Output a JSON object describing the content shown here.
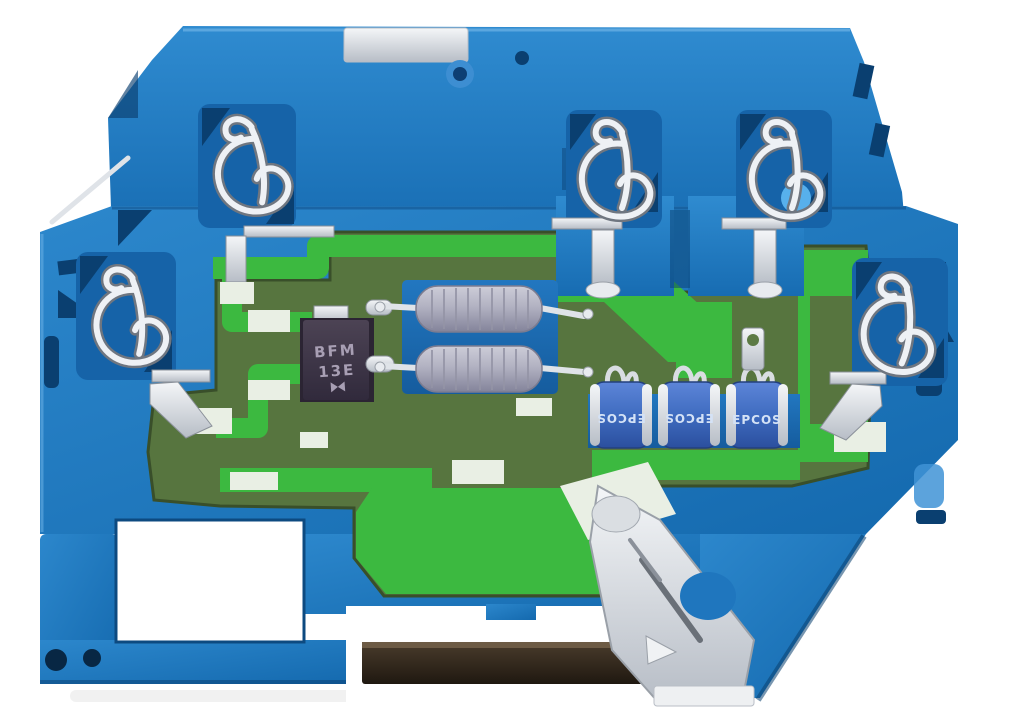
{
  "scene": {
    "subject": "Blue DIN-rail terminal block surge-protection module with exposed green PCB",
    "background": "#ffffff"
  },
  "labels": {
    "diode": {
      "line1": "BFM",
      "line2": "13E"
    },
    "gas_discharge_tubes": [
      {
        "brand": "EPCOS",
        "orientation": "upside-down"
      },
      {
        "brand": "EPCOS",
        "orientation": "upside-down"
      },
      {
        "brand": "EPCOS",
        "orientation": "upright"
      }
    ]
  },
  "colors": {
    "housing_blue": "#1d79c2",
    "housing_blue_light": "#3a93d6",
    "housing_navy": "#0a3f70",
    "pcb_olive": "#57753f",
    "pcb_trace_green": "#3cb940",
    "pcb_pad_white": "#e9efe4",
    "metal_silver": "#e8ebef",
    "diode_body": "#3b3343",
    "diode_text": "#a89fb4",
    "inductor_gray": "#b0b0bf",
    "tube_blue": "#3f6cc0",
    "test_port_light_blue": "#57b0ec",
    "din_rail_dark": "#31271d"
  }
}
